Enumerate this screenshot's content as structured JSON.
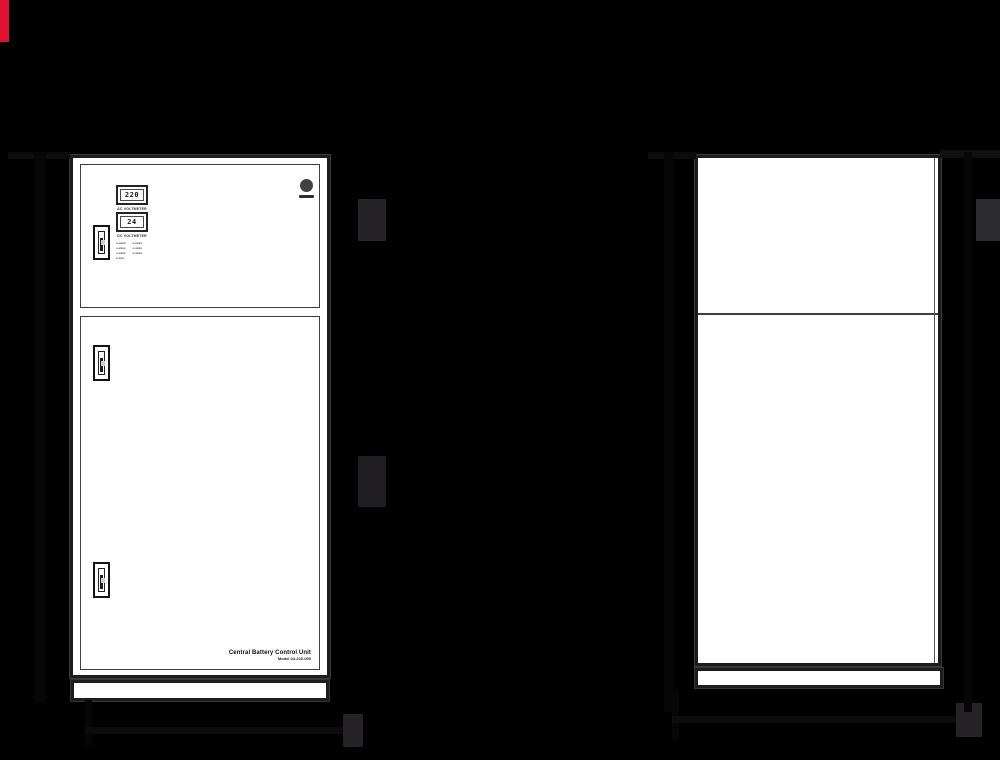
{
  "page": {
    "background_color": "#000000",
    "accent_bar_color": "#e11231"
  },
  "front_view": {
    "meters": [
      {
        "value": "220",
        "label": "AC VOLTMETER"
      },
      {
        "value": "24",
        "label": "DC VOLTMETER"
      }
    ],
    "indicators": {
      "rows": [
        {
          "left": "o-xxxx",
          "right": "v-xxxx"
        },
        {
          "left": "o-xxxx",
          "right": "o-xxxx"
        },
        {
          "left": "o-xxxx",
          "right": "o-xxxx"
        },
        {
          "left": "o-xxx",
          "right": ""
        }
      ]
    },
    "nameplate": {
      "title": "Central Battery Control Unit",
      "model": "Model 04-220-000"
    }
  },
  "icons": {
    "brand_logo": "filled-circle"
  }
}
